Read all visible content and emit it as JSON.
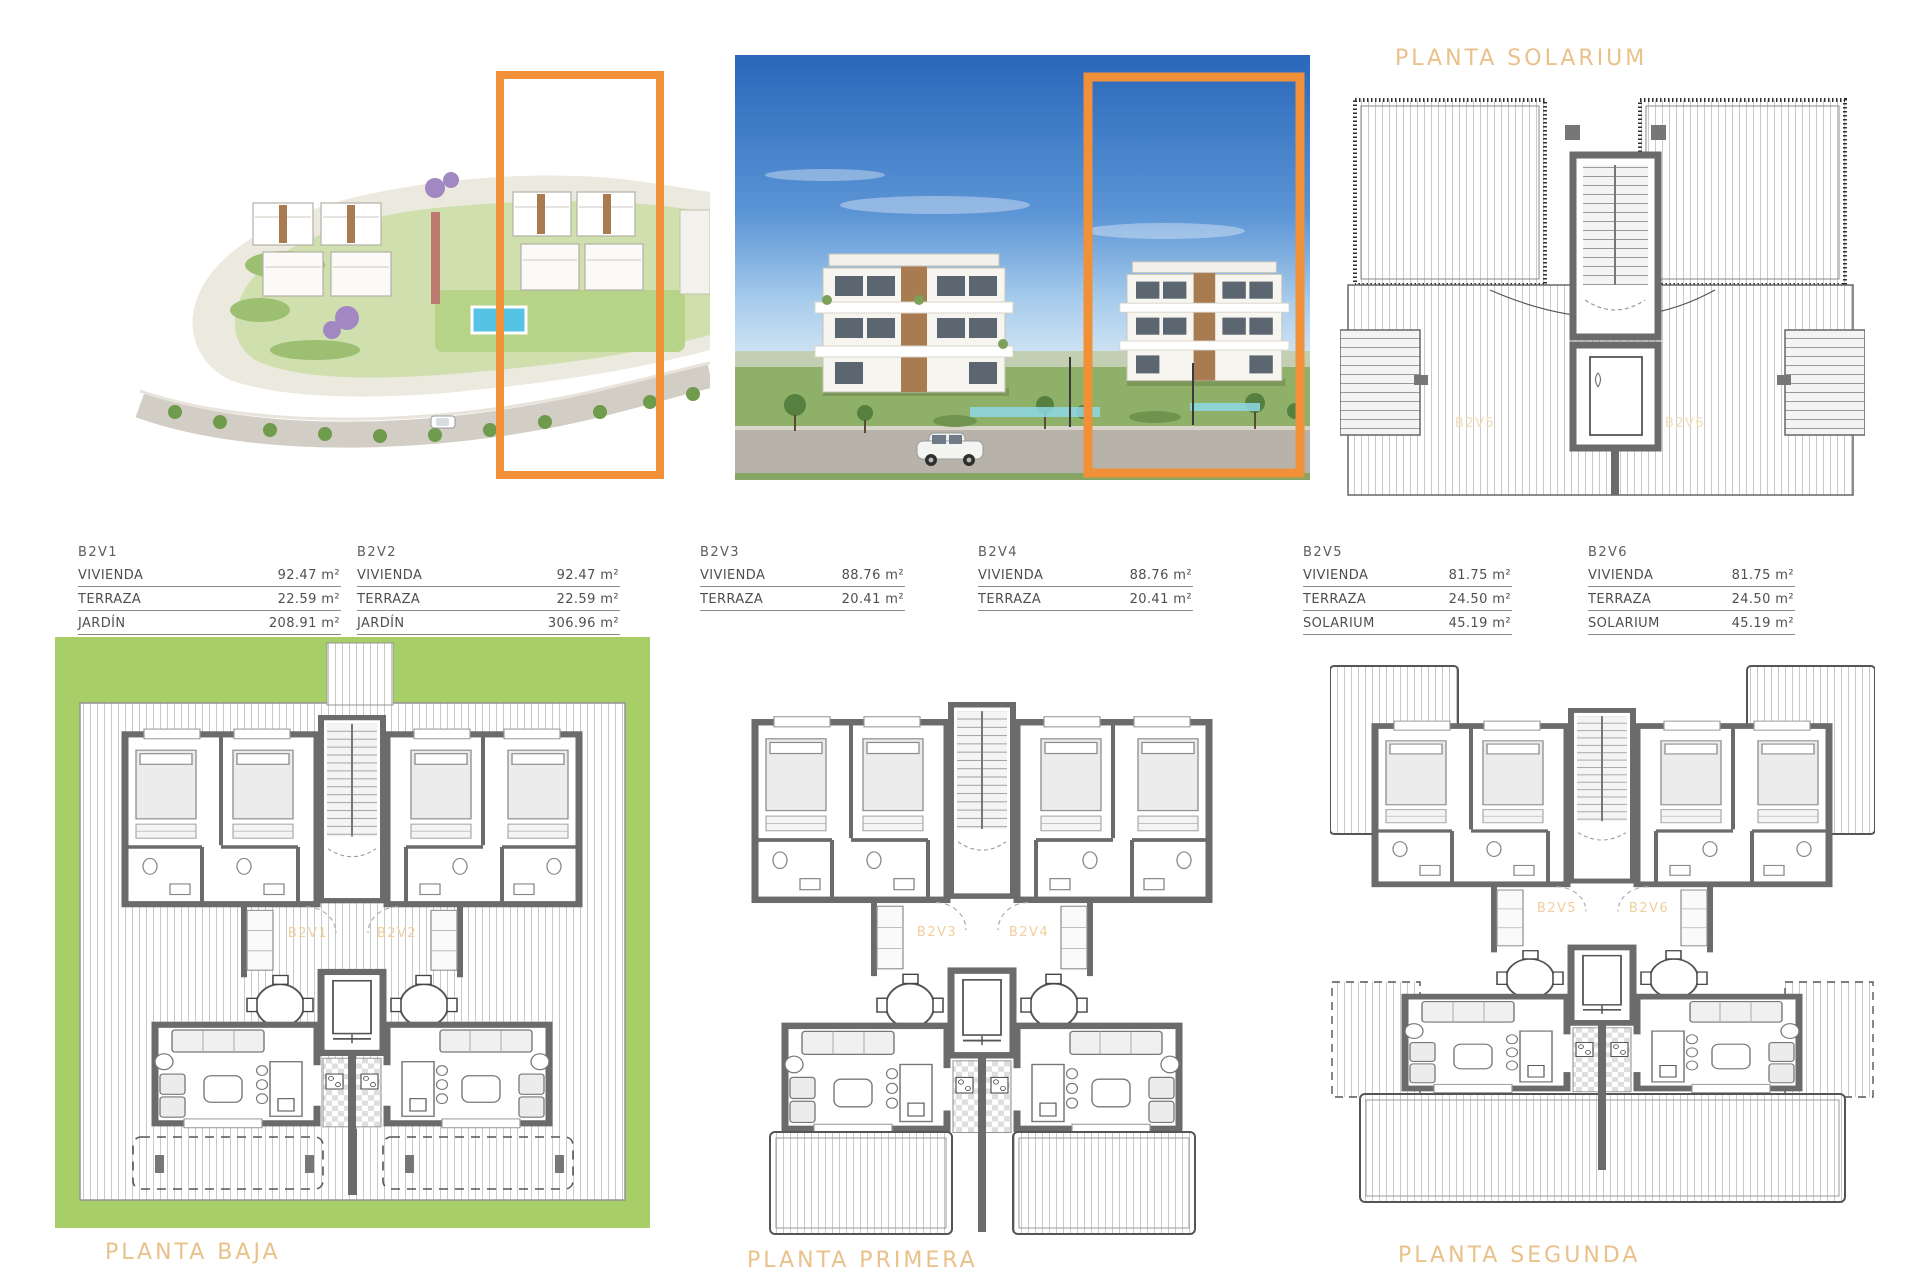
{
  "titles": {
    "block": "BLOQUE 2"
  },
  "plans": {
    "solarium": {
      "title": "PLANTA SOLARIUM",
      "units": [
        "B2V5",
        "B2V6"
      ]
    },
    "baja": {
      "title": "PLANTA BAJA",
      "units": [
        "B2V1",
        "B2V2"
      ]
    },
    "primera": {
      "title": "PLANTA PRIMERA",
      "units": [
        "B2V3",
        "B2V4"
      ]
    },
    "segunda": {
      "title": "PLANTA SEGUNDA",
      "units": [
        "B2V5",
        "B2V6"
      ]
    }
  },
  "unit_tables": [
    {
      "unit": "B2V1",
      "rows": [
        {
          "label": "VIVIENDA",
          "value": "92.47 m²"
        },
        {
          "label": "TERRAZA",
          "value": "22.59 m²"
        },
        {
          "label": "JARDÍN",
          "value": "208.91 m²"
        }
      ]
    },
    {
      "unit": "B2V2",
      "rows": [
        {
          "label": "VIVIENDA",
          "value": "92.47 m²"
        },
        {
          "label": "TERRAZA",
          "value": "22.59 m²"
        },
        {
          "label": "JARDÍN",
          "value": "306.96 m²"
        }
      ]
    },
    {
      "unit": "B2V3",
      "rows": [
        {
          "label": "VIVIENDA",
          "value": "88.76 m²"
        },
        {
          "label": "TERRAZA",
          "value": "20.41 m²"
        }
      ]
    },
    {
      "unit": "B2V4",
      "rows": [
        {
          "label": "VIVIENDA",
          "value": "88.76 m²"
        },
        {
          "label": "TERRAZA",
          "value": "20.41 m²"
        }
      ]
    },
    {
      "unit": "B2V5",
      "rows": [
        {
          "label": "VIVIENDA",
          "value": "81.75 m²"
        },
        {
          "label": "TERRAZA",
          "value": "24.50 m²"
        },
        {
          "label": "SOLARIUM",
          "value": "45.19 m²"
        }
      ]
    },
    {
      "unit": "B2V6",
      "rows": [
        {
          "label": "VIVIENDA",
          "value": "81.75 m²"
        },
        {
          "label": "TERRAZA",
          "value": "24.50 m²"
        },
        {
          "label": "SOLARIUM",
          "value": "45.19 m²"
        }
      ]
    }
  ],
  "colors": {
    "accent_text": "#e9c18a",
    "highlight_box": "#f0913a",
    "garden_green": "#a8ce68",
    "wall_gray": "#6b6b6b"
  }
}
